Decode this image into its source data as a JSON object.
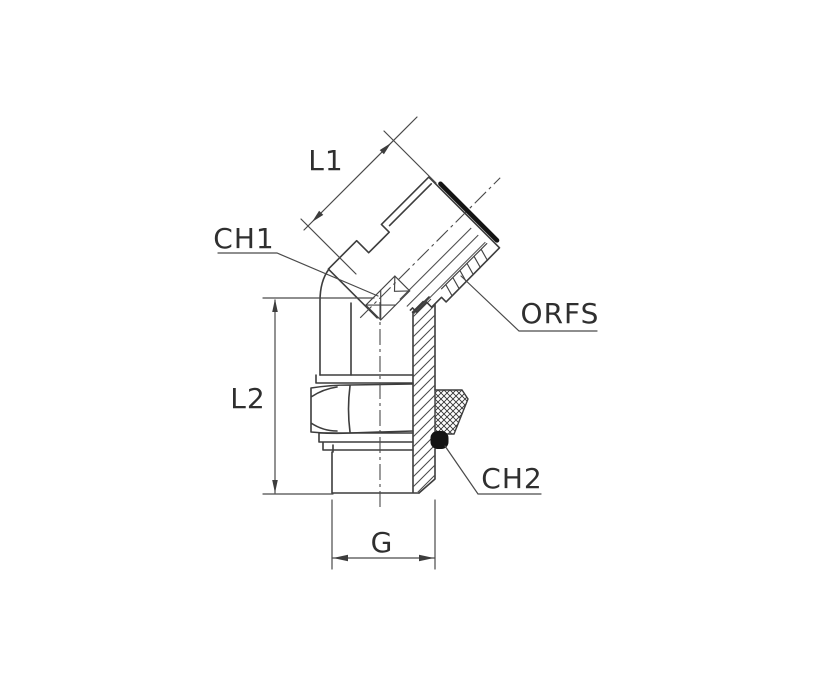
{
  "drawing": {
    "description": "technical line drawing of a 45-degree ORFS adjustable elbow fitting, half-sectioned",
    "labels": {
      "l1": "L1",
      "ch1": "CH1",
      "orfs": "ORFS",
      "l2": "L2",
      "ch2": "CH2",
      "g": "G"
    },
    "colors": {
      "background": "#ffffff",
      "line": "#3d3d3d",
      "text": "#2f2f2f",
      "oring_seal": "#141414"
    }
  }
}
